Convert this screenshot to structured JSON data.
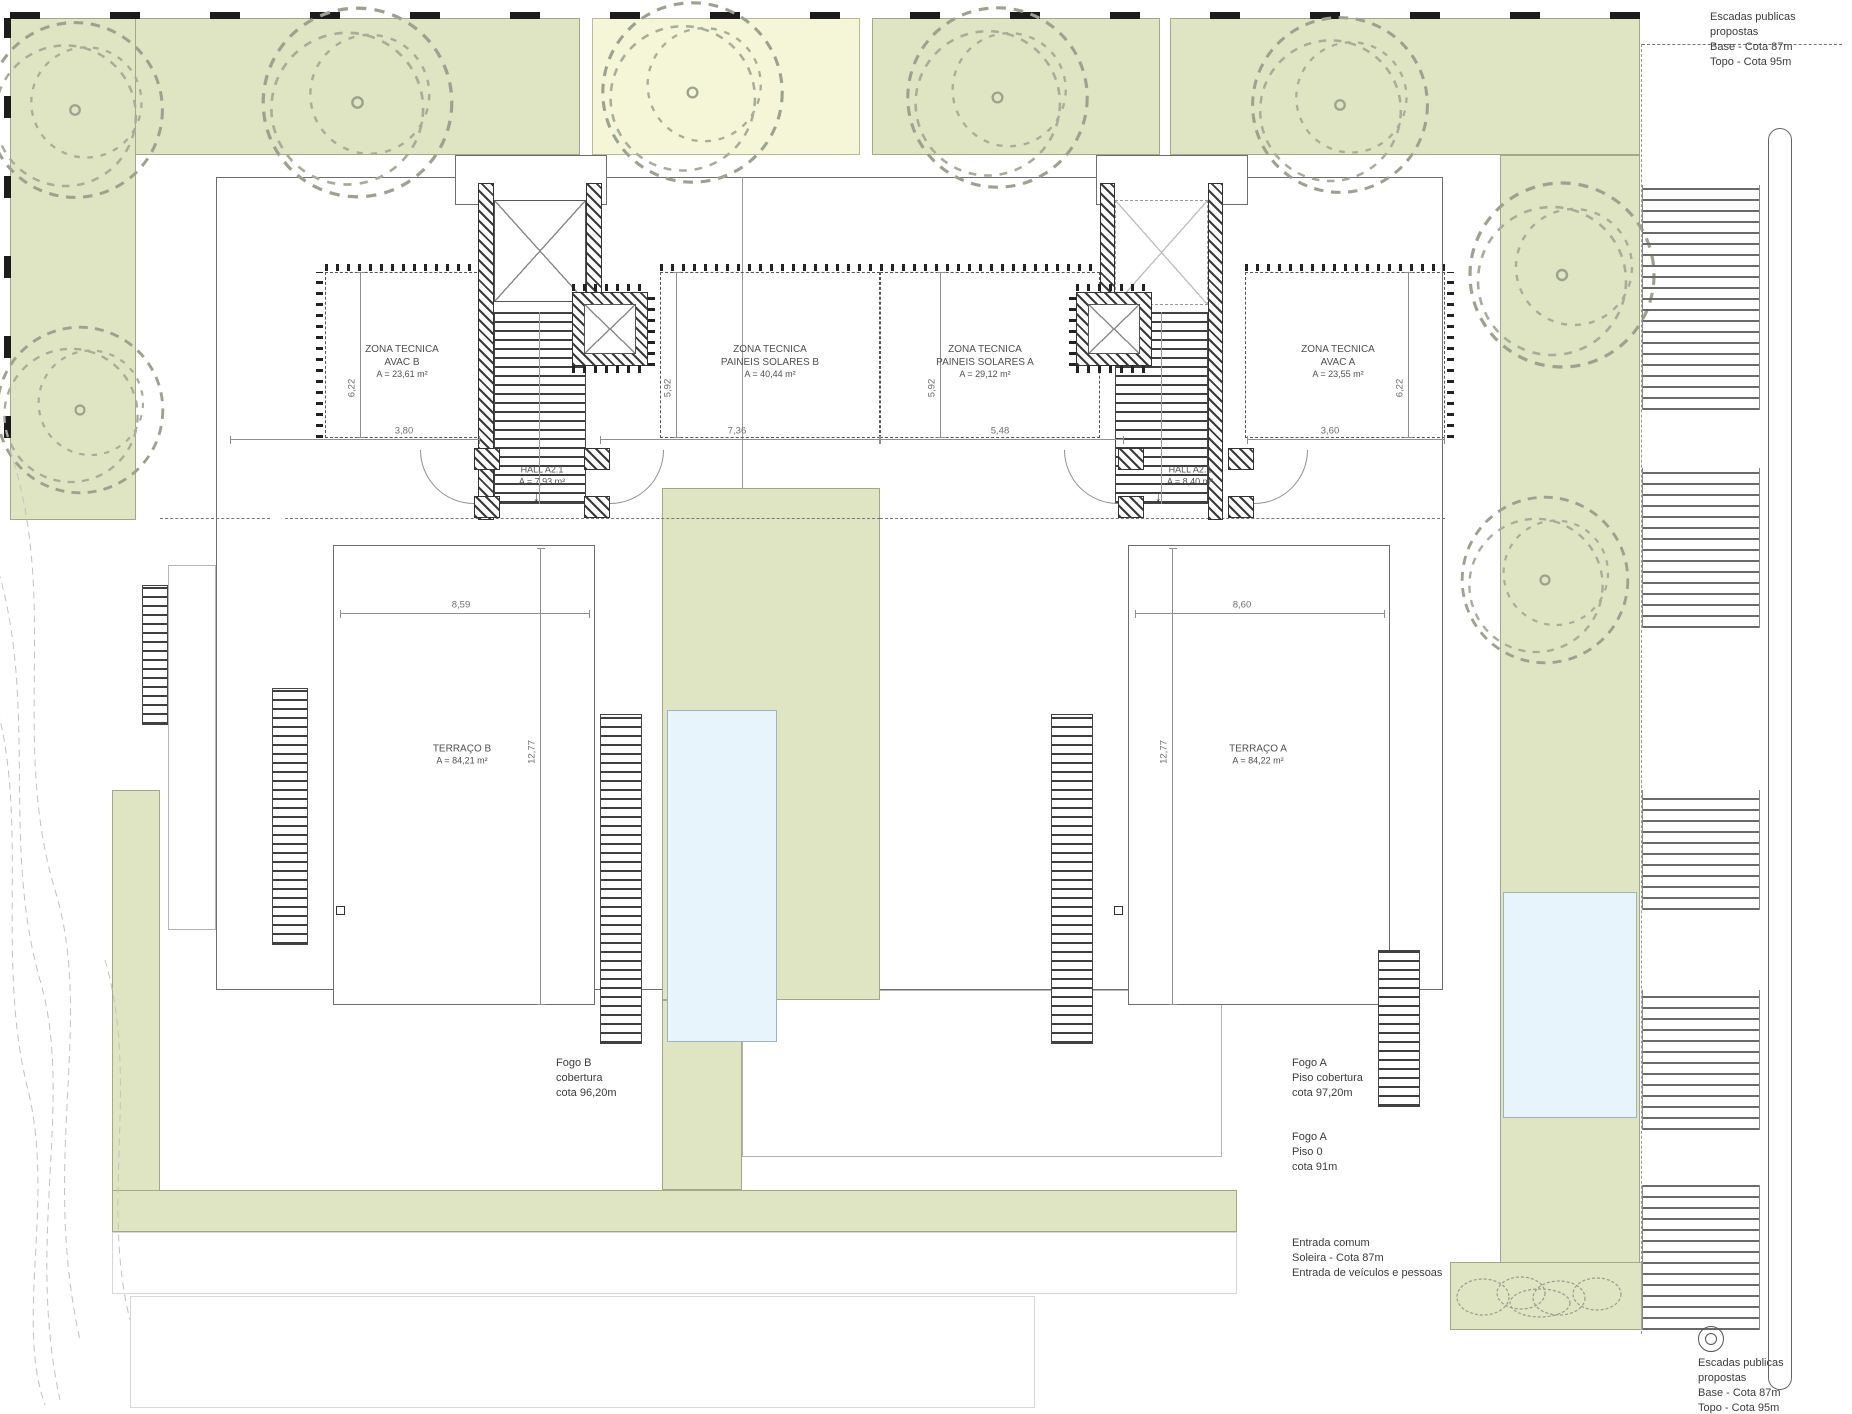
{
  "colors": {
    "vegetation_green": "#dfe4c2",
    "pale_yellow": "#f5f6d8",
    "pool_blue": "#e7f4fb",
    "wall_hatch": "#3a3a3a",
    "line_gray": "#8f8f8f",
    "text_gray": "#4f4f4f"
  },
  "zones": {
    "avac_b": {
      "l1": "ZONA TECNICA",
      "l2": "AVAC B",
      "l3": "A = 23,61 m²"
    },
    "solar_b": {
      "l1": "ZONA TECNICA",
      "l2": "PAINEIS SOLARES B",
      "l3": "A = 40,44 m²"
    },
    "solar_a": {
      "l1": "ZONA TECNICA",
      "l2": "PAINEIS SOLARES A",
      "l3": "A = 29,12 m²"
    },
    "avac_a": {
      "l1": "ZONA TECNICA",
      "l2": "AVAC A",
      "l3": "A = 23,55 m²"
    },
    "hall_b": {
      "l1": "HALL A2.1",
      "l2": "A = 7,93 m²"
    },
    "hall_a": {
      "l1": "HALL A2.1",
      "l2": "A = 8,40 m²"
    },
    "terraco_b": {
      "l1": "TERRAÇO B",
      "l2": "A = 84,21 m²"
    },
    "terraco_a": {
      "l1": "TERRAÇO A",
      "l2": "A = 84,22 m²"
    }
  },
  "units": {
    "fogo_b": {
      "l1": "Fogo B",
      "l2": "cobertura",
      "l3": "cota 96,20m"
    },
    "fogo_a_cob": {
      "l1": "Fogo A",
      "l2": "Piso cobertura",
      "l3": "cota 97,20m"
    },
    "fogo_a_p0": {
      "l1": "Fogo A",
      "l2": "Piso 0",
      "l3": "cota 91m"
    }
  },
  "notes": {
    "stairs_top": {
      "l1": "Escadas publicas",
      "l2": "propostas",
      "l3": "Base - Cota 87m",
      "l4": "Topo - Cota 95m"
    },
    "stairs_bottom": {
      "l1": "Escadas publicas",
      "l2": "propostas",
      "l3": "Base - Cota 87m",
      "l4": "Topo - Cota 95m"
    },
    "entrance": {
      "l1": "Entrada comum",
      "l2": "Soleira - Cota 87m",
      "l3": "Entrada de veículos e pessoas"
    }
  },
  "dimensions": {
    "top_b_left": "3,80",
    "top_b_right": "7,36",
    "top_a_left": "5,48",
    "top_a_right": "3,60",
    "terrace_b_width": "8,59",
    "terrace_a_width": "8,60",
    "terrace_b_height": "12,77",
    "terrace_a_height": "12,77",
    "avac_b_height": "6,22",
    "avac_a_height": "6,22",
    "solar_b_height": "5,92",
    "solar_a_height": "5,92"
  }
}
